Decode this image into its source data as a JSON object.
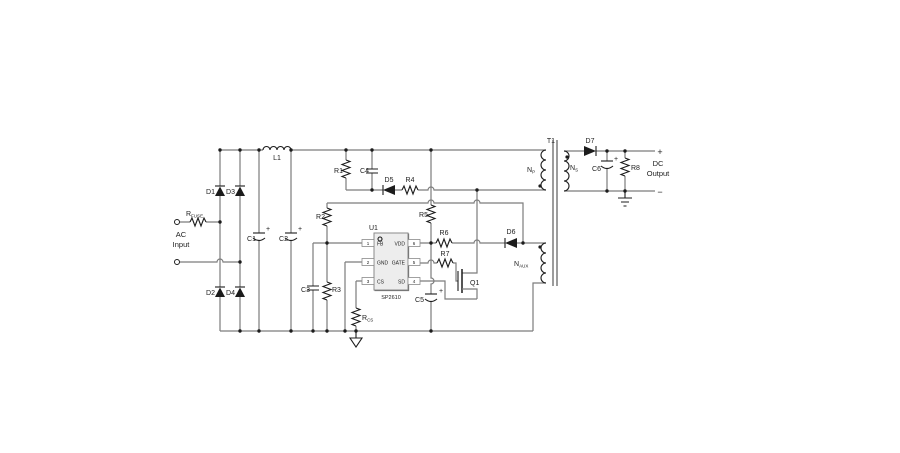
{
  "colors": {
    "wire": "#7c7c7c",
    "component": "#1c1c1c",
    "ic_fill": "#ededed",
    "ic_border": "#8a8a8a",
    "background": "#ffffff"
  },
  "schematic": {
    "source": {
      "ac_label_line1": "AC",
      "ac_label_line2": "Input",
      "fuse": {
        "main": "R",
        "sub": "FUSE"
      }
    },
    "bridge": {
      "d1": "D1",
      "d2": "D2",
      "d3": "D3",
      "d4": "D4"
    },
    "input_filter": {
      "l1": "L1",
      "c1": "C1",
      "c2": "C2",
      "c1_plus": "+",
      "c2_plus": "+"
    },
    "snubber": {
      "r1": "R1",
      "c4": "C4",
      "d5": "D5",
      "r4": "R4"
    },
    "feedback": {
      "r2": "R2",
      "c3": "C3",
      "r3": "R3"
    },
    "controller": {
      "ref": "U1",
      "part": "SP2610",
      "pins_left": [
        {
          "num": "1",
          "name": "FB"
        },
        {
          "num": "2",
          "name": "GND"
        },
        {
          "num": "3",
          "name": "CS"
        }
      ],
      "pins_right": [
        {
          "num": "6",
          "name": "VDD"
        },
        {
          "num": "5",
          "name": "GATE"
        },
        {
          "num": "4",
          "name": "SD"
        }
      ]
    },
    "bias": {
      "r5": "R5",
      "r6": "R6",
      "r7": "R7",
      "d6": "D6",
      "c5": "C5",
      "c5_plus": "+",
      "rcs": {
        "main": "R",
        "sub": "CS"
      }
    },
    "switch": {
      "q1": "Q1"
    },
    "transformer": {
      "ref": "T1",
      "primary": {
        "main": "N",
        "sub": "P"
      },
      "secondary": {
        "main": "N",
        "sub": "S"
      },
      "auxiliary": {
        "main": "N",
        "sub": "AUX"
      }
    },
    "output": {
      "d7": "D7",
      "c6": "C6",
      "c6_plus": "+",
      "r8": "R8",
      "plus": "+",
      "minus": "−",
      "label_line1": "DC",
      "label_line2": "Output"
    }
  }
}
